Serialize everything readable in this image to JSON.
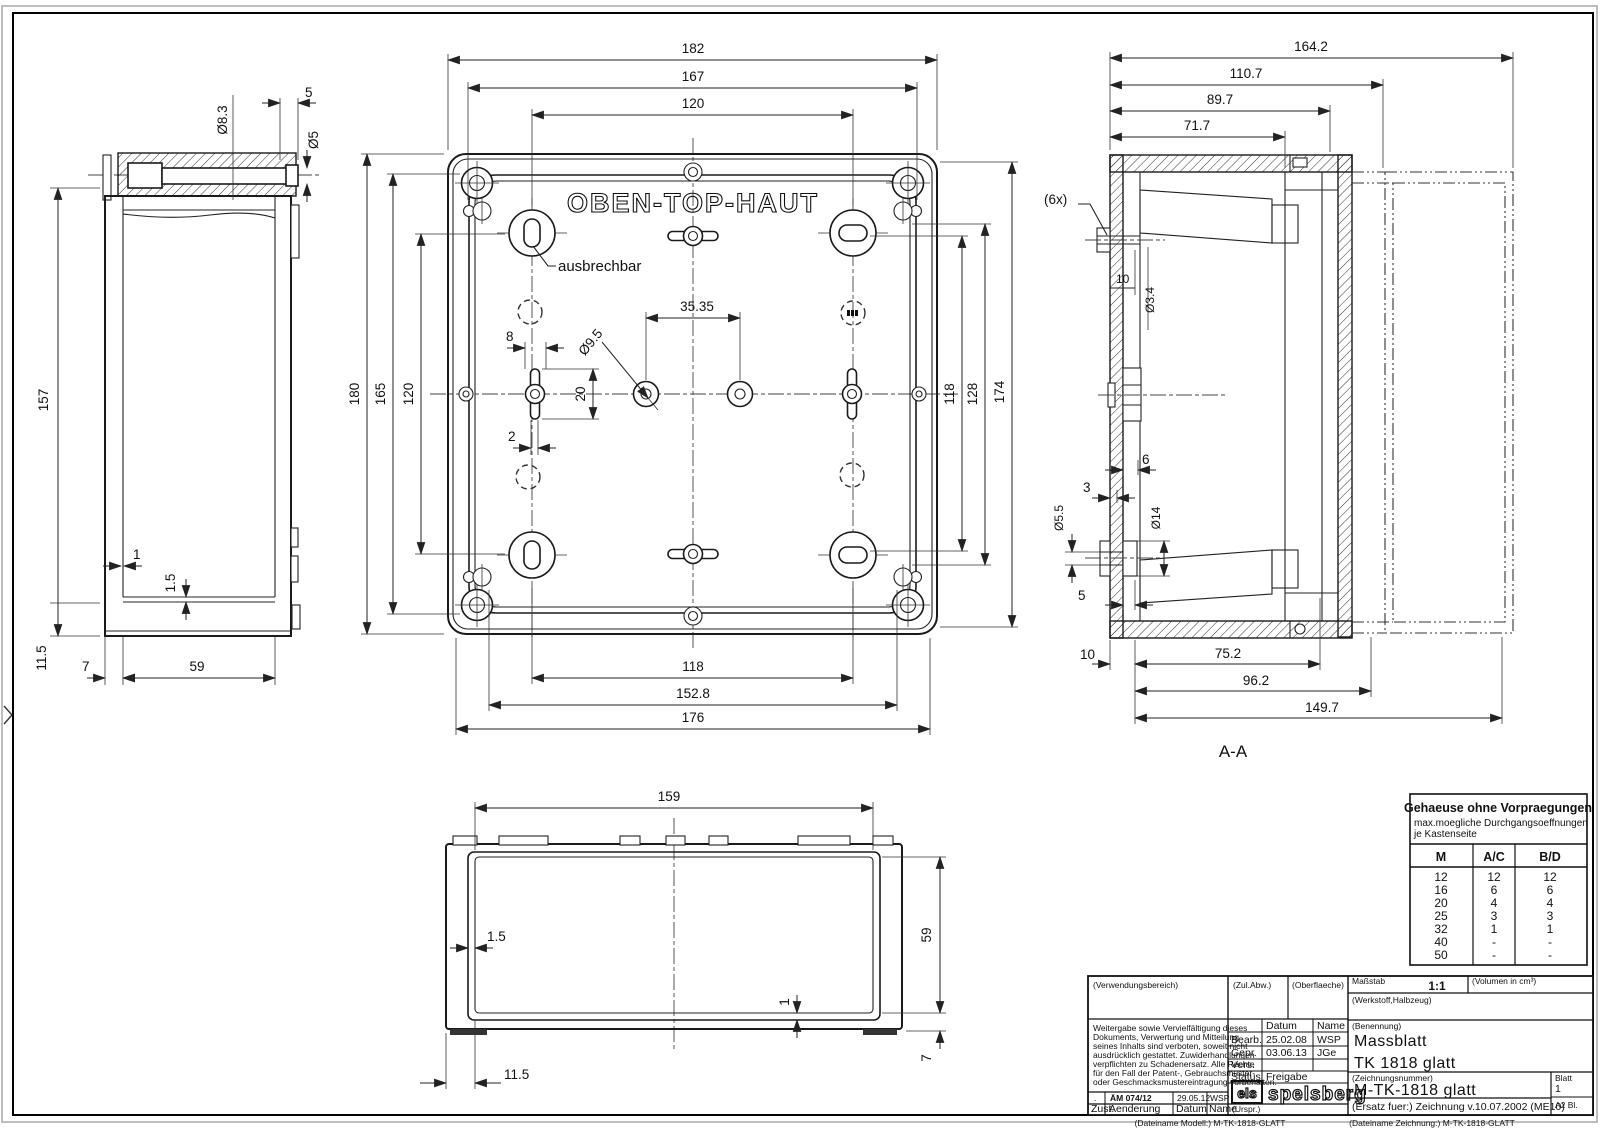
{
  "side_view": {
    "dims": {
      "dia83": "Ø8.3",
      "d5_top": "5",
      "dia5": "Ø5",
      "d157": "157",
      "d1": "1",
      "d15": "1.5",
      "d115": "11.5",
      "d7": "7",
      "d59": "59"
    }
  },
  "top_view": {
    "title": "OBEN-TOP-HAUT",
    "note": "ausbrechbar",
    "dims": {
      "d182": "182",
      "d167": "167",
      "d120_top": "120",
      "d180": "180",
      "d165": "165",
      "d120_left": "120",
      "d3535": "35.35",
      "d8": "8",
      "d20": "20",
      "d2": "2",
      "dia95": "Ø9.5",
      "d118_right": "118",
      "d128": "128",
      "d174": "174",
      "d118_bottom": "118",
      "d1528": "152.8",
      "d176": "176"
    }
  },
  "section_view": {
    "label": "A-A",
    "note_6x": "(6x)",
    "dims": {
      "d1642": "164.2",
      "d1107": "110.7",
      "d897": "89.7",
      "d717": "71.7",
      "dia34": "Ø3.4",
      "d10_top": "10",
      "d6": "6",
      "d3": "3",
      "dia55": "Ø5.5",
      "dia14": "Ø14",
      "d5": "5",
      "d10_bottom": "10",
      "d752": "75.2",
      "d962": "96.2",
      "d1497": "149.7"
    }
  },
  "front_view": {
    "dims": {
      "d159": "159",
      "d15": "1.5",
      "d1": "1",
      "d59": "59",
      "d7": "7",
      "d115": "11.5"
    }
  },
  "knockout_table": {
    "title": "Gehaeuse ohne Vorpraegungen",
    "subtitle1": "max.moegliche Durchgangsoeffnungen",
    "subtitle2": "je Kastenseite",
    "col_m": "M",
    "col_ac": "A/C",
    "col_bd": "B/D",
    "rows": [
      {
        "m": "12",
        "ac": "12",
        "bd": "12"
      },
      {
        "m": "16",
        "ac": "6",
        "bd": "6"
      },
      {
        "m": "20",
        "ac": "4",
        "bd": "4"
      },
      {
        "m": "25",
        "ac": "3",
        "bd": "3"
      },
      {
        "m": "32",
        "ac": "1",
        "bd": "1"
      },
      {
        "m": "40",
        "ac": "-",
        "bd": "-"
      },
      {
        "m": "50",
        "ac": "-",
        "bd": "-"
      }
    ]
  },
  "title_block": {
    "verwendungsbereich": "(Verwendungsbereich)",
    "legal1": "Weitergabe sowie Vervielfältigung dieses",
    "legal2": "Dokuments, Verwertung und Mitteilung",
    "legal3": "seines Inhalts sind verboten, soweit nicht",
    "legal4": "ausdrücklich gestattet. Zuwiderhandlungen",
    "legal5": "verpflichten zu Schadenersatz. Alle Rechte",
    "legal6": "für den Fall der Patent-, Gebrauchsmuster-",
    "legal7": "oder Geschmacksmustereintragung vorbehalten.",
    "zul_abw": "(Zul.Abw.)",
    "oberflaeche": "(Oberflaeche)",
    "massstab_label": "Maßstab",
    "massstab_value": "1:1",
    "volumen_label": "(Volumen in cm³)",
    "werkstoff": "(Werkstoff,Halbzeug)",
    "datum_col": "Datum",
    "name_col": "Name",
    "bearb_label": "Bearb.",
    "bearb_datum": "25.02.08",
    "bearb_name": "WSP",
    "gepr_label": "Gepr.",
    "gepr_datum": "03.06.13",
    "gepr_name": "JGe",
    "vers_label": "Vers.",
    "status_label": "Status",
    "status_value": "Freigabe",
    "benennung_label": "(Benennung)",
    "benennung_line1": "Massblatt",
    "benennung_line2": "TK 1818 glatt",
    "zeichnungsnummer_label": "(Zeichnungsnummer)",
    "zeichnungsnummer": "M-TK-1818 glatt",
    "blatt_label": "Blatt",
    "blatt_value": "1",
    "blatt_format": "A2  Bl.",
    "ersatz": "(Ersatz fuer:)  Zeichnung v.10.07.2002 (ME10)",
    "rev_dot": ".",
    "rev_aem": "ÄM 074/12",
    "rev_datum": "29.05.12",
    "rev_name": "WSP",
    "zust_label": "Zust.",
    "aenderung_label": "Aenderung",
    "datum_label": "Datum",
    "name_label": "Name",
    "urspr_label": "(Urspr.)",
    "logo_els": "els",
    "logo_spelsberg": "spelsberg",
    "dateiname_modell": "(Dateiname Modell:) M-TK-1818-GLATT",
    "dateiname_zeichnung": "(Dateiname Zeichnung:) M-TK-1818-GLATT"
  }
}
